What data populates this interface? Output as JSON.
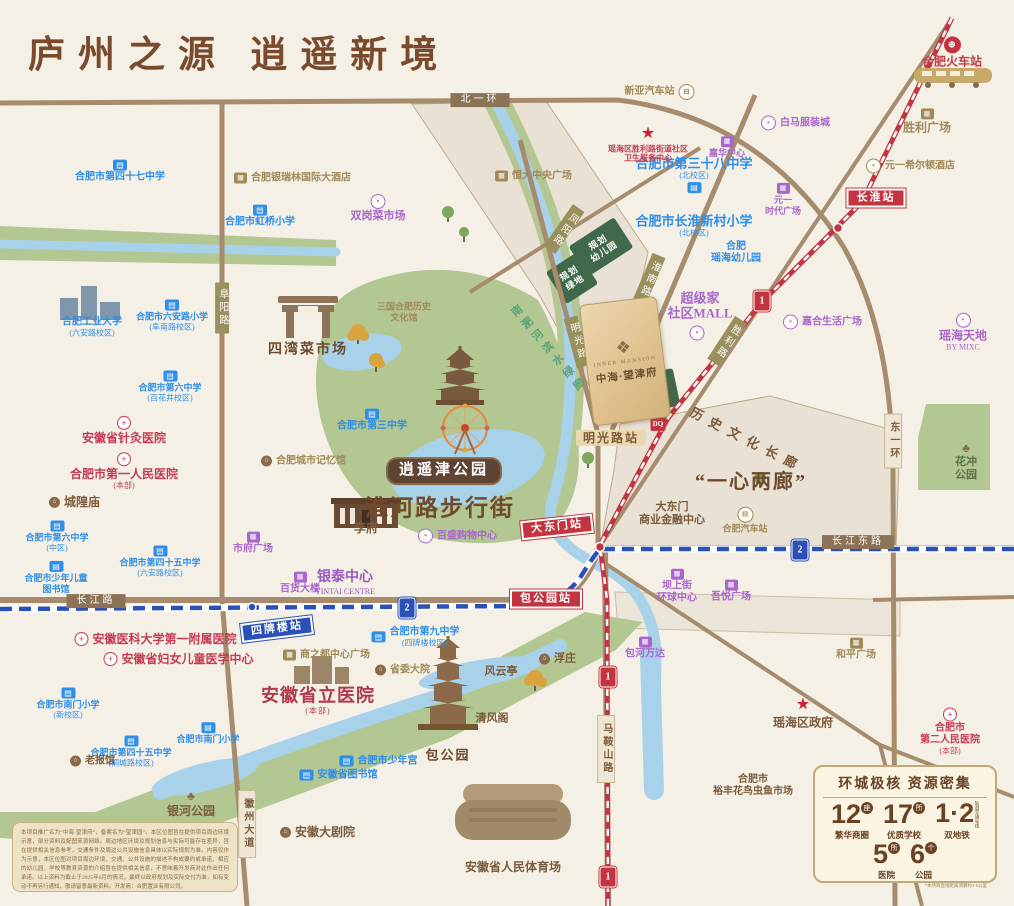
{
  "title": "庐州之源  逍遥新境",
  "project": {
    "name_en": "INNER MANSION",
    "name": "中海·望津府",
    "logo": "❖"
  },
  "colors": {
    "accent_brown": "#7a4a2c",
    "metro1_red": "#c23540",
    "metro2_blue": "#2b50b8",
    "school_blue": "#2f8ee8",
    "hospital_red": "#c53b52",
    "mall_purple": "#aa66cc",
    "gold": "#a18a58",
    "park_green": "#b2c792",
    "water_blue": "#a8d2ea"
  },
  "stats_panel": {
    "title": "环城极核  资源密集",
    "items": [
      {
        "num": "12",
        "unit": "座",
        "label": "繁华商圈"
      },
      {
        "num": "17",
        "unit": "所",
        "label": "优质学校"
      },
      {
        "num": "1·2",
        "tag": "轨道交通号线",
        "label": "双地铁"
      },
      {
        "num": "5",
        "unit": "所",
        "label": "医院"
      },
      {
        "num": "6",
        "unit": "个",
        "label": "公园"
      }
    ],
    "note": "*本项目直线距离测算约3-6公里"
  },
  "disclaimer": {
    "text": "本项目推广名为“中海·望津府”，备案名为“望津园”。本区位图旨在提供项目周边环境示意，部分资料及配图来源网络。周边地区环境及规划信息与实际可能存在差异，旨在提供相关信息参考，交通条件及周边公共设施信息具体以实际规划为准。内容仅作为示意，本区位图对项目周边环境、交通、公共设施的描述不构成要约或承诺，相应的幼儿园、学校等教育资源的介绍旨在提供相关信息，不意味着开发商对此作出任何承诺。以上资料为截止于2025年6月的情况，最终以政府规划及实际交付为准，如有变动不再另行通知，敬请留意最新资料。开发商：合肥置业有限公司。"
  },
  "map": {
    "labels": [
      {
        "id": "road-label-beiyihuan",
        "t": "北一环",
        "x": 480,
        "y": 100,
        "c": "rd"
      },
      {
        "id": "road-label-changjianglu",
        "t": "长江路",
        "x": 96,
        "y": 601,
        "c": "rd"
      },
      {
        "id": "road-label-changjiangdonglu",
        "t": "长江东路",
        "x": 858,
        "y": 542,
        "c": "rd"
      },
      {
        "id": "road-label-dongyihuan",
        "t": "东一环",
        "x": 893,
        "y": 441,
        "c": "rdt"
      },
      {
        "id": "road-label-maanshanlu",
        "t": "马鞍山路",
        "x": 606,
        "y": 749,
        "c": "rdt"
      },
      {
        "id": "road-label-huizhoudadao",
        "t": "徽州大道",
        "x": 247,
        "y": 824,
        "c": "rdt"
      },
      {
        "id": "road-label-fuyanglu",
        "t": "阜阳路",
        "x": 222,
        "y": 308,
        "c": "rdo"
      },
      {
        "id": "road-label-huainanlu",
        "t": "淮南路",
        "x": 649,
        "y": 279,
        "c": "rdo",
        "rot": 23
      },
      {
        "id": "road-label-mingguanglu",
        "t": "明光路",
        "x": 577,
        "y": 342,
        "c": "rdo",
        "rot": -15
      },
      {
        "id": "road-label-shenglilu",
        "t": "胜利路",
        "x": 727,
        "y": 341,
        "c": "rdo",
        "rot": 33
      },
      {
        "id": "road-label-fengyanglu",
        "t": "凤阳路",
        "x": 564,
        "y": 229,
        "c": "rdo",
        "rot": 35
      },
      {
        "id": "station-changhuai",
        "t": "长淮站",
        "x": 876,
        "y": 198,
        "c": "stR"
      },
      {
        "id": "station-dadongmen",
        "t": "大东门站",
        "x": 557,
        "y": 527,
        "c": "stR",
        "rot": -6
      },
      {
        "id": "station-baogongyuan",
        "t": "包公园站",
        "x": 546,
        "y": 599,
        "c": "stR"
      },
      {
        "id": "station-sipailou",
        "t": "四牌楼站",
        "x": 277,
        "y": 629,
        "c": "stB",
        "rot": -7
      },
      {
        "id": "station-mingguanglu",
        "t": "明光路站",
        "x": 611,
        "y": 438,
        "c": "stT"
      },
      {
        "id": "metro-line1-badge",
        "x": 762,
        "y": 301,
        "c": "mb",
        "ic": "m1"
      },
      {
        "id": "metro-line1-badge",
        "x": 608,
        "y": 677,
        "c": "mb",
        "ic": "m1"
      },
      {
        "id": "metro-line1-badge",
        "x": 608,
        "y": 877,
        "c": "mb",
        "ic": "m1"
      },
      {
        "id": "metro-line2-badge",
        "x": 407,
        "y": 608,
        "c": "mb",
        "ic": "m2"
      },
      {
        "id": "metro-line2-badge",
        "x": 800,
        "y": 550,
        "c": "mb",
        "ic": "m2"
      },
      {
        "id": "dq-badge",
        "x": 658,
        "y": 424,
        "c": "mb",
        "ic": "dq"
      },
      {
        "id": "school-label",
        "t": "合肥市第四十七中学",
        "x": 120,
        "y": 171,
        "c": "sch",
        "ic": "sch",
        "ip": "t"
      },
      {
        "id": "school-label",
        "t": "合肥市虹桥小学",
        "x": 260,
        "y": 216,
        "c": "sch",
        "ic": "sch",
        "ip": "t"
      },
      {
        "id": "school-label",
        "t": "合肥工业大学\n(六安路校区)",
        "x": 92,
        "y": 327,
        "c": "sch"
      },
      {
        "id": "school-label",
        "t": "合肥市六安路小学\n(阜南路校区)",
        "x": 172,
        "y": 315,
        "c": "sch",
        "fs": 9,
        "ic": "sch",
        "ip": "t"
      },
      {
        "id": "school-label",
        "t": "合肥市第六中学\n(百花井校区)",
        "x": 170,
        "y": 386,
        "c": "sch",
        "fs": 9,
        "ic": "sch",
        "ip": "t"
      },
      {
        "id": "school-label",
        "t": "合肥市第三中学",
        "x": 372,
        "y": 420,
        "c": "sch",
        "ic": "sch",
        "ip": "t"
      },
      {
        "id": "school-label",
        "t": "合肥市第六中学\n(中区)",
        "x": 57,
        "y": 536,
        "c": "sch",
        "fs": 9,
        "ic": "sch",
        "ip": "t"
      },
      {
        "id": "school-label",
        "t": "合肥市少年儿童\n图书馆",
        "x": 56,
        "y": 577,
        "c": "sch",
        "fs": 9,
        "ic": "sch",
        "ip": "t"
      },
      {
        "id": "school-label",
        "t": "合肥市第四十五中学\n(六安路校区)",
        "x": 160,
        "y": 561,
        "c": "sch",
        "fs": 9,
        "ic": "sch",
        "ip": "t"
      },
      {
        "id": "school-label",
        "t": "合肥市南门小学\n(新校区)",
        "x": 68,
        "y": 703,
        "c": "sch",
        "fs": 9,
        "ic": "sch",
        "ip": "t"
      },
      {
        "id": "school-label",
        "t": "合肥市第四十五中学\n(桐城路校区)",
        "x": 131,
        "y": 751,
        "c": "sch",
        "fs": 9,
        "ic": "sch",
        "ip": "t"
      },
      {
        "id": "school-label",
        "t": "合肥市南门小学",
        "x": 208,
        "y": 733,
        "c": "sch",
        "fs": 9,
        "ic": "sch",
        "ip": "t"
      },
      {
        "id": "school-label",
        "t": "合肥市第九中学\n(四牌楼校区)",
        "x": 415,
        "y": 637,
        "c": "sch",
        "ic": "sch",
        "ip": "l"
      },
      {
        "id": "school-label",
        "t": "合肥市少年宫",
        "x": 378,
        "y": 761,
        "c": "sch",
        "ic": "sch",
        "ip": "l"
      },
      {
        "id": "school-label",
        "t": "安徽省图书馆",
        "x": 338,
        "y": 775,
        "c": "sch",
        "ic": "sch",
        "ip": "l"
      },
      {
        "id": "school-label",
        "t": "合肥市第三十八中学\n(北校区)",
        "x": 694,
        "y": 175,
        "c": "sch",
        "fs": 13,
        "ic": "sch",
        "ip": "b"
      },
      {
        "id": "school-label",
        "t": "合肥市长淮新村小学\n(北校区)",
        "x": 694,
        "y": 226,
        "c": "sch",
        "fs": 13
      },
      {
        "id": "school-label",
        "t": "合肥\n瑶海幼儿园",
        "x": 736,
        "y": 253,
        "c": "sch"
      },
      {
        "id": "hospital-label",
        "t": "安徽省针灸医院",
        "x": 124,
        "y": 430,
        "c": "hos",
        "fs": 12,
        "ic": "hos",
        "ip": "t"
      },
      {
        "id": "hospital-label",
        "t": "合肥市第一人民医院\n(本部)",
        "x": 124,
        "y": 471,
        "c": "hos",
        "fs": 12,
        "ic": "hos",
        "ip": "t"
      },
      {
        "id": "hospital-label",
        "t": "安徽医科大学第一附属医院",
        "x": 155,
        "y": 639,
        "c": "hos",
        "fs": 12,
        "ic": "hos",
        "ip": "l"
      },
      {
        "id": "hospital-label",
        "t": "安徽省妇女儿童医学中心",
        "x": 178,
        "y": 659,
        "c": "hos",
        "fs": 12,
        "ic": "hos",
        "ip": "l"
      },
      {
        "id": "hospital-label",
        "t": "合肥市\n第二人民医院\n(本部)",
        "x": 950,
        "y": 731,
        "c": "hos",
        "ic": "hos",
        "ip": "t"
      },
      {
        "id": "clinic-label",
        "t": "瑶海区胜利路街道社区\n卫生服务中心",
        "x": 648,
        "y": 144,
        "c": "hos",
        "fs": 8,
        "ic": "star",
        "ip": "t"
      },
      {
        "id": "hospital-label",
        "t": "安徽省立医院\n(本部)",
        "x": 318,
        "y": 701,
        "c": "redB"
      },
      {
        "id": "market-label",
        "t": "双岗菜市场",
        "x": 378,
        "y": 208,
        "c": "pur",
        "fs": 11,
        "ic": "purO",
        "ip": "t"
      },
      {
        "id": "mall-label",
        "t": "白马服装城",
        "x": 795,
        "y": 123,
        "c": "pur",
        "ic": "purO",
        "ip": "l"
      },
      {
        "id": "mall-label",
        "t": "嘉华中心",
        "x": 727,
        "y": 147,
        "c": "pur",
        "fs": 9,
        "ic": "pur",
        "ip": "t"
      },
      {
        "id": "mall-label",
        "t": "元一\n时代广场",
        "x": 783,
        "y": 199,
        "c": "pur",
        "fs": 9,
        "ic": "pur",
        "ip": "t"
      },
      {
        "id": "mall-label",
        "t": "超级家\n社区MALL",
        "x": 700,
        "y": 306,
        "c": "pur",
        "fs": 13
      },
      {
        "id": "mall-icon",
        "x": 697,
        "y": 333,
        "c": "mb",
        "ic": "purO"
      },
      {
        "id": "mall-label",
        "t": "嘉合生活广场",
        "x": 822,
        "y": 322,
        "c": "pur",
        "ic": "purO",
        "ip": "l"
      },
      {
        "id": "mall-label",
        "t": "瑶海天地\nBY MIXC",
        "x": 963,
        "y": 332,
        "c": "pur",
        "fs": 12,
        "ic": "purO",
        "ip": "t"
      },
      {
        "id": "mall-label",
        "t": "市府广场",
        "x": 253,
        "y": 543,
        "c": "pur",
        "ic": "pur",
        "ip": "t"
      },
      {
        "id": "mall-label",
        "t": "百货大楼",
        "x": 300,
        "y": 583,
        "c": "pur",
        "ic": "pur",
        "ip": "t"
      },
      {
        "id": "mall-label",
        "t": "百盛购物中心",
        "x": 457,
        "y": 536,
        "c": "pur",
        "ic": "purO",
        "ip": "l"
      },
      {
        "id": "mall-label",
        "t": "银泰中心\nYINTAI CENTRE",
        "x": 345,
        "y": 583,
        "c": "purB"
      },
      {
        "id": "mall-label",
        "t": "坝上街\n环球中心",
        "x": 677,
        "y": 586,
        "c": "pur",
        "ic": "pur",
        "ip": "t"
      },
      {
        "id": "mall-label",
        "t": "吾悦广场",
        "x": 731,
        "y": 591,
        "c": "pur",
        "ic": "pur",
        "ip": "t"
      },
      {
        "id": "mall-label",
        "t": "包河万达",
        "x": 645,
        "y": 648,
        "c": "pur",
        "ic": "pur",
        "ip": "t"
      },
      {
        "id": "hotel-label",
        "t": "合肥银瑞林国际大酒店",
        "x": 292,
        "y": 178,
        "c": "gld",
        "ic": "gld",
        "ip": "l"
      },
      {
        "id": "mall-label",
        "t": "恒大中央广场",
        "x": 533,
        "y": 176,
        "c": "gld",
        "ic": "gld",
        "ip": "l"
      },
      {
        "id": "bus-station-label",
        "t": "新亚汽车站",
        "x": 660,
        "y": 92,
        "c": "gld",
        "ic": "bus",
        "ip": "r"
      },
      {
        "id": "railway-station-label",
        "t": "合肥火车站",
        "x": 952,
        "y": 52,
        "c": "rail",
        "ic": "rail",
        "ip": "t"
      },
      {
        "id": "mall-label",
        "t": "胜利广场",
        "x": 927,
        "y": 121,
        "c": "gld",
        "fs": 12,
        "ic": "gld",
        "ip": "t"
      },
      {
        "id": "hotel-label",
        "t": "元一希尔顿酒店",
        "x": 910,
        "y": 166,
        "c": "gld",
        "ic": "gldO",
        "ip": "l"
      },
      {
        "id": "market-label",
        "t": "四湾菜市场",
        "x": 308,
        "y": 351,
        "c": "brnB"
      },
      {
        "id": "museum-label",
        "t": "三国合肥历史\n文化馆",
        "x": 404,
        "y": 312,
        "c": "gld",
        "fs": 9
      },
      {
        "id": "museum-label",
        "t": "合肥城市记忆馆",
        "x": 303,
        "y": 461,
        "c": "gld",
        "ic": "dot",
        "ip": "l"
      },
      {
        "id": "temple-label",
        "t": "城隍庙",
        "x": 74,
        "y": 502,
        "c": "brn",
        "fs": 12,
        "ic": "dot",
        "ip": "l"
      },
      {
        "id": "landmark-label",
        "t": "李府",
        "x": 366,
        "y": 528,
        "c": "brn",
        "fs": 12
      },
      {
        "id": "bus-station-label",
        "t": "合肥汽车站",
        "x": 745,
        "y": 520,
        "c": "gld",
        "fs": 9,
        "ic": "bus",
        "ip": "t"
      },
      {
        "id": "district-label",
        "t": "大东门\n商业金融中心",
        "x": 672,
        "y": 514,
        "c": "brn",
        "fs": 11
      },
      {
        "id": "mall-label",
        "t": "商之都中心广场",
        "x": 326,
        "y": 655,
        "c": "gld",
        "ic": "gld",
        "ip": "l"
      },
      {
        "id": "landmark-label",
        "t": "省委大院",
        "x": 402,
        "y": 670,
        "c": "gld",
        "ic": "dot",
        "ip": "l"
      },
      {
        "id": "pavilion-label",
        "t": "风云亭",
        "x": 501,
        "y": 672,
        "c": "brn",
        "fs": 11
      },
      {
        "id": "pavilion-label",
        "t": "浮庄",
        "x": 557,
        "y": 659,
        "c": "brn",
        "fs": 11,
        "ic": "dot",
        "ip": "l"
      },
      {
        "id": "pavilion-label",
        "t": "清风阁",
        "x": 492,
        "y": 719,
        "c": "brn",
        "fs": 11
      },
      {
        "id": "park-label",
        "t": "包公园",
        "x": 448,
        "y": 755,
        "c": "brnB",
        "fs": 13
      },
      {
        "id": "museum-label",
        "t": "老报馆",
        "x": 92,
        "y": 761,
        "c": "brn",
        "ic": "dot",
        "ip": "l"
      },
      {
        "id": "park-label",
        "t": "银河公园",
        "x": 191,
        "y": 803,
        "c": "brn",
        "fs": 12,
        "ic": "tree",
        "ip": "t"
      },
      {
        "id": "theater-label",
        "t": "安徽大剧院",
        "x": 317,
        "y": 832,
        "c": "brn",
        "fs": 12,
        "ic": "dot",
        "ip": "l"
      },
      {
        "id": "stadium-label",
        "t": "安徽省人民体育场",
        "x": 513,
        "y": 867,
        "c": "brn",
        "fs": 12
      },
      {
        "id": "mall-label",
        "t": "和平广场",
        "x": 856,
        "y": 649,
        "c": "gld",
        "ic": "gld",
        "ip": "t"
      },
      {
        "id": "government-label",
        "t": "瑶海区政府",
        "x": 803,
        "y": 713,
        "c": "brn",
        "fs": 12,
        "ic": "star",
        "ip": "t"
      },
      {
        "id": "market-label",
        "t": "合肥市\n裕丰花鸟虫鱼市场",
        "x": 753,
        "y": 786,
        "c": "brn"
      },
      {
        "id": "park-label",
        "t": "花冲\n公园",
        "x": 966,
        "y": 461,
        "c": "grnD",
        "ic": "tree",
        "ip": "t"
      },
      {
        "id": "corridor-label",
        "t": "历史文化长廊",
        "x": 747,
        "y": 440,
        "c": "brn",
        "fs": 13,
        "rot": 27,
        "sp": 1
      },
      {
        "id": "slogan-label",
        "t": "“一心两廊”",
        "x": 751,
        "y": 483,
        "c": "brnB",
        "fs": 20
      },
      {
        "id": "street-label",
        "t": "淮河路步行街",
        "x": 440,
        "y": 508,
        "c": "brnB",
        "fs": 23
      },
      {
        "id": "park-badge",
        "t": "逍遥津公园",
        "x": 444,
        "y": 471,
        "c": "badge"
      },
      {
        "id": "greenway-label",
        "t": "南淝河滨水绿廊",
        "x": 548,
        "y": 350,
        "c": "grnT",
        "rot": -40
      },
      {
        "id": "planned-kindergarten-label",
        "t": "规划\n幼儿园",
        "x": 601,
        "y": 247,
        "c": "wht",
        "rot": -33
      },
      {
        "id": "planned-green-label",
        "t": "规划\n绿地",
        "x": 572,
        "y": 278,
        "c": "wht",
        "rot": -33
      },
      {
        "id": "park-green-label",
        "t": "公园\n绿地",
        "x": 656,
        "y": 391,
        "c": "wht",
        "rot": -12
      }
    ]
  }
}
